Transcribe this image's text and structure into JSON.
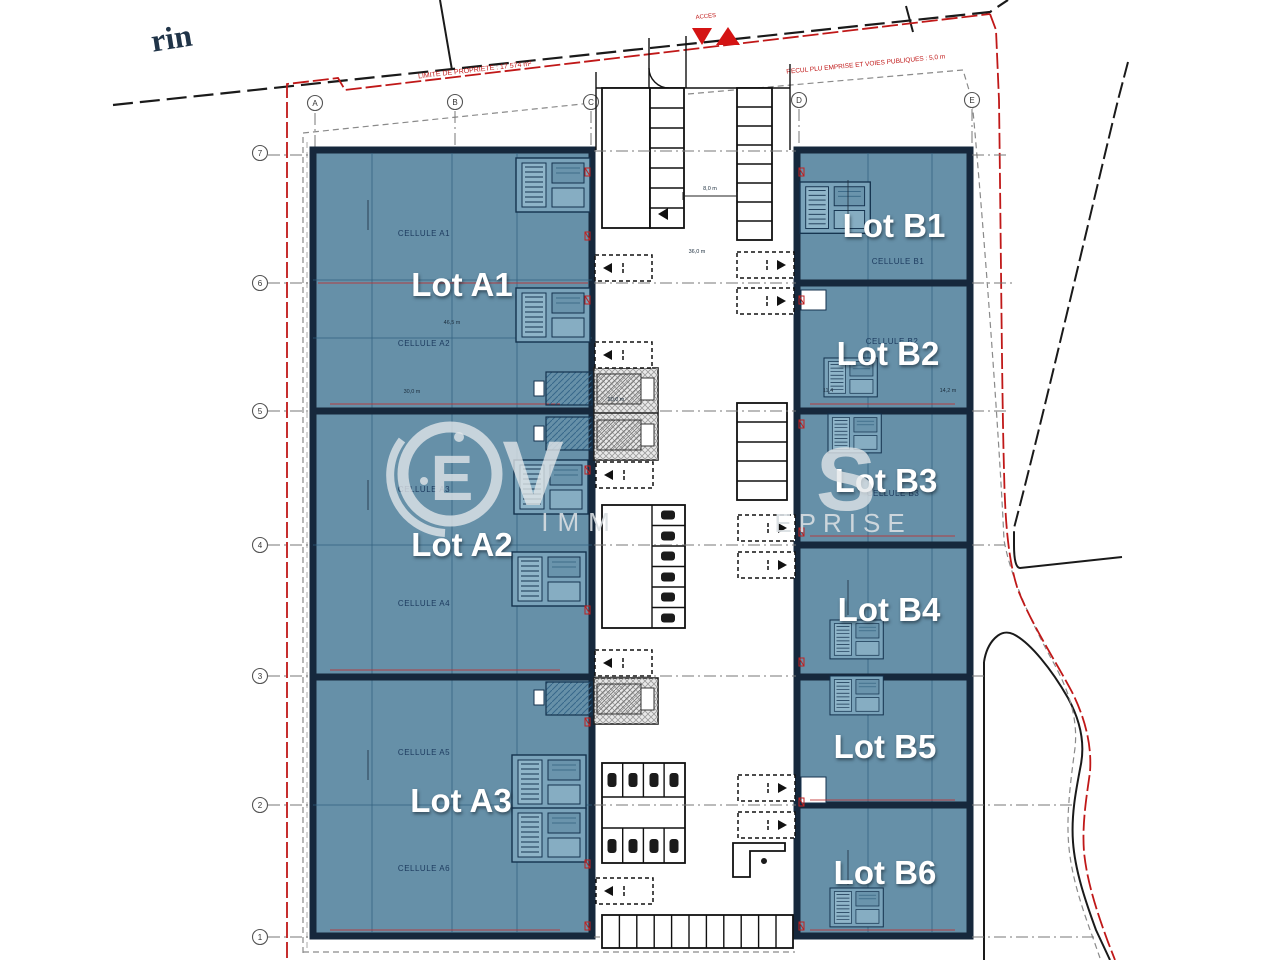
{
  "page": {
    "street_name_fragment": "rin"
  },
  "annotations": {
    "acces_label": "ACCES",
    "property_limit_label": "LIMITE DE PROPRIETE : 17 574 m²",
    "setback_label": "RECUL PLU EMPRISE ET VOIES PUBLIQUES : 5,0 m"
  },
  "grid": {
    "columns": [
      {
        "label": "A"
      },
      {
        "label": "B"
      },
      {
        "label": "C"
      },
      {
        "label": "D"
      },
      {
        "label": "E"
      }
    ],
    "rows": [
      {
        "label": "7"
      },
      {
        "label": "6"
      },
      {
        "label": "5"
      },
      {
        "label": "4"
      },
      {
        "label": "3"
      },
      {
        "label": "2"
      },
      {
        "label": "1"
      }
    ]
  },
  "lots": {
    "a": [
      {
        "label": "Lot A1"
      },
      {
        "label": "Lot A2"
      },
      {
        "label": "Lot A3"
      }
    ],
    "b": [
      {
        "label": "Lot B1"
      },
      {
        "label": "Lot B2"
      },
      {
        "label": "Lot B3"
      },
      {
        "label": "Lot B4"
      },
      {
        "label": "Lot B5"
      },
      {
        "label": "Lot B6"
      }
    ]
  },
  "cells": {
    "a": [
      {
        "label": "CELLULE A1"
      },
      {
        "label": "CELLULE A2"
      },
      {
        "label": "CELLULE A3"
      },
      {
        "label": "CELLULE A4"
      },
      {
        "label": "CELLULE A5"
      },
      {
        "label": "CELLULE A6"
      }
    ],
    "b": [
      {
        "label": "CELLULE B1"
      },
      {
        "label": "CELLULE B2"
      },
      {
        "label": "CELLULE B3"
      }
    ]
  },
  "dimensions": {
    "d8": "8,0 m",
    "d36": "36,0 m",
    "d20": "20,0 m",
    "d465": "46,5 m",
    "d300": "30,0 m",
    "d114": "11,4",
    "d142": "14,2 m"
  },
  "watermark": {
    "letter_e": "E",
    "letter_v": "V",
    "letter_s": "S",
    "sub_left": "IMM",
    "sub_right": "EPRISE"
  },
  "colors": {
    "building_fill": "#6690a8",
    "building_border": "#16283c",
    "boundary_red": "#c01818",
    "detail_blue": "#2f5e7d",
    "watermark": "#e3e7ea"
  }
}
